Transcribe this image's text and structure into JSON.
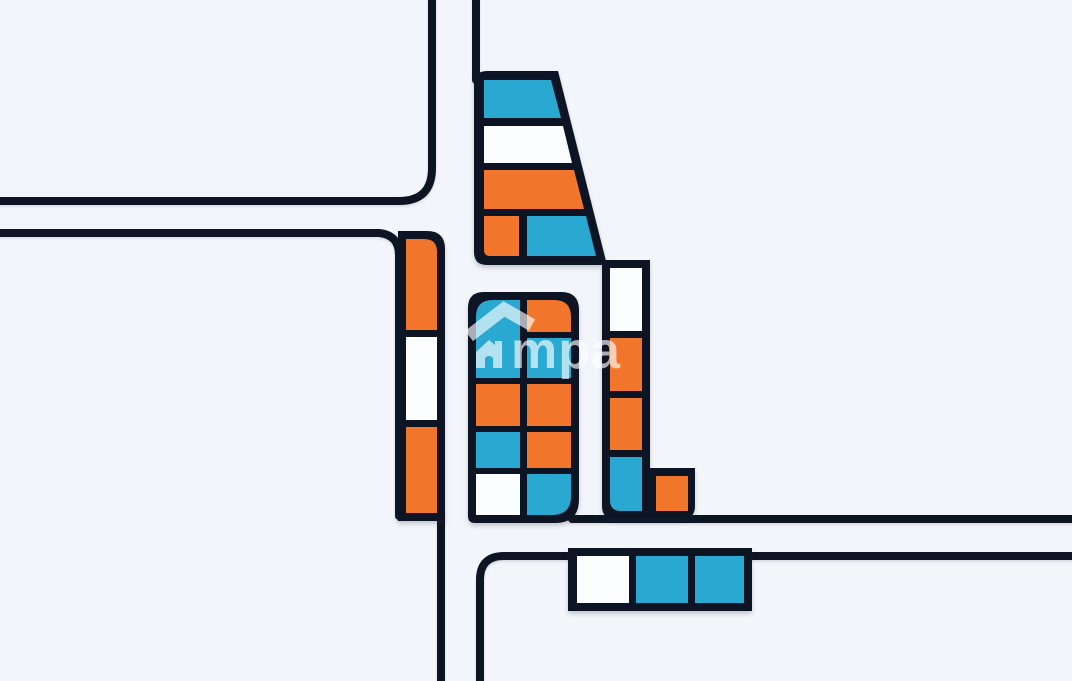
{
  "watermark": {
    "text": "mpa",
    "icon": "house-roof-icon"
  },
  "palette": {
    "background": "#F2F5F9",
    "outline": "#0D1424",
    "orange": "#F1762B",
    "teal": "#29A9D1",
    "white": "#FCFDFF"
  },
  "map": {
    "roads": [
      {
        "name": "top-left-block-edge",
        "d": "M -12,201 H 399 Q 432,201 432,168 V -12"
      },
      {
        "name": "west-block-top-edge",
        "d": "M -12,233 H 379 Q 399,235 399,255 V 516"
      },
      {
        "name": "south-road-west-edge",
        "d": "M 441,513 V 693"
      },
      {
        "name": "north-road-east-edge",
        "d": "M 476,-12 V 80"
      },
      {
        "name": "southeast-block-edge",
        "d": "M 480,693 V 580 Q 480,556 504,556 H 1084"
      },
      {
        "name": "east-road-top-edge",
        "d": "M 572,519 H 1084"
      }
    ],
    "blocks": [
      {
        "name": "north-trapezoid-block",
        "outline": "M 474,84 Q 474,71 487,71 H 558 L 607,265 H 487 Q 474,265 474,252 Z",
        "cells": [
          {
            "color": "teal",
            "d": "M 484,80 H 551 L 561,118 H 484 Z"
          },
          {
            "color": "white",
            "d": "M 484,126 H 563 L 572,163 H 484 Z"
          },
          {
            "color": "orange",
            "d": "M 484,170 H 574 L 584,209 H 484 Z"
          },
          {
            "color": "orange",
            "d": "M 484,216 H 519 V 256 H 490 Q 484,256 484,250 Z"
          },
          {
            "color": "teal",
            "d": "M 527,216 H 586 L 596,256 H 527 Z"
          }
        ]
      },
      {
        "name": "west-strip-block",
        "outline": "M 398,231 H 427 Q 445,231 445,249 V 521 H 398 Z",
        "cells": [
          {
            "color": "orange",
            "d": "M 406,239 H 424 Q 437,239 437,252 V 330 H 406 Z"
          },
          {
            "color": "white",
            "d": "M 406,337 H 437 V 420 H 406 Z"
          },
          {
            "color": "orange",
            "d": "M 406,427 H 437 V 513 H 406 Z"
          }
        ]
      },
      {
        "name": "central-block",
        "outline": "M 484,292 H 561 Q 579,292 579,310 V 499 Q 579,523 555,523 H 475 Q 468,523 468,516 V 308 Q 468,292 484,292 Z",
        "cells": [
          {
            "color": "teal",
            "d": "M 476,317 Q 476,300 493,300 H 520 V 378 H 476 Z"
          },
          {
            "color": "orange",
            "d": "M 476,384 H 520 V 426 H 476 Z"
          },
          {
            "color": "teal",
            "d": "M 476,432 H 520 V 468 H 476 Z"
          },
          {
            "color": "white",
            "d": "M 476,474 H 520 V 515 H 476 Z"
          },
          {
            "color": "orange",
            "d": "M 527,300 H 554 Q 571,300 571,317 V 332 H 527 Z"
          },
          {
            "color": "teal",
            "d": "M 527,338 H 571 V 378 H 527 Z"
          },
          {
            "color": "orange",
            "d": "M 527,384 H 571 V 426 H 527 Z"
          },
          {
            "color": "orange",
            "d": "M 527,432 H 571 V 468 H 527 Z"
          },
          {
            "color": "teal",
            "d": "M 527,474 H 571 V 496 Q 571,515 552,515 H 527 Z"
          }
        ]
      },
      {
        "name": "east-l-block",
        "outline": "M 602,260 H 650 V 468 H 695 V 506 Q 695,519 682,519 H 615 Q 602,519 602,506 Z",
        "cells": [
          {
            "color": "white",
            "d": "M 610,268 H 642 V 331 H 610 Z"
          },
          {
            "color": "orange",
            "d": "M 610,338 H 642 V 391 H 610 Z"
          },
          {
            "color": "orange",
            "d": "M 610,398 H 642 V 450 H 610 Z"
          },
          {
            "color": "teal",
            "d": "M 610,457 H 642 V 511 H 621 Q 610,511 610,500 Z"
          },
          {
            "color": "orange",
            "d": "M 656,476 H 688 V 511 H 656 Z"
          }
        ]
      },
      {
        "name": "south-row-block",
        "outline": "M 568,548 H 752 V 611 H 568 Z",
        "cells": [
          {
            "color": "white",
            "d": "M 577,556 H 629 V 603 H 577 Z"
          },
          {
            "color": "teal",
            "d": "M 636,556 H 688 V 603 H 636 Z"
          },
          {
            "color": "teal",
            "d": "M 695,556 H 744 V 603 H 695 Z"
          }
        ]
      }
    ]
  }
}
